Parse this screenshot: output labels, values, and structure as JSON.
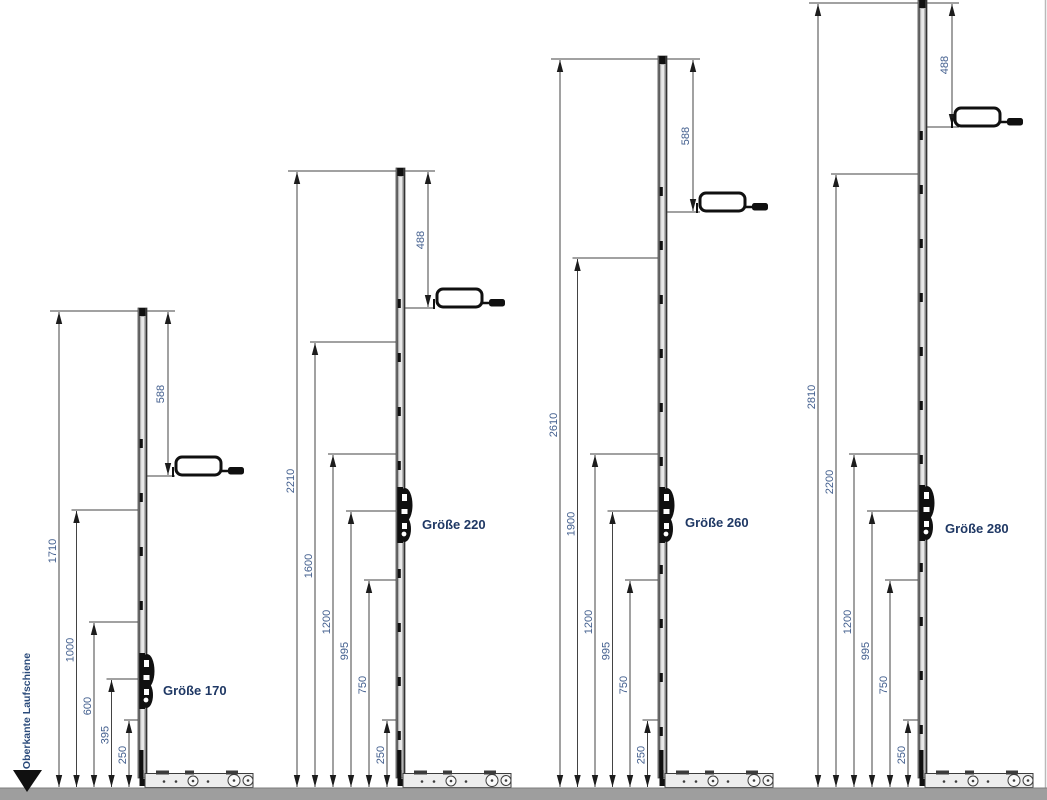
{
  "drawing": {
    "datum_label": "Oberkante Laufschiene",
    "units": [
      {
        "name": "Größe 170",
        "total_mm": 1710,
        "left_dims_mm": [
          1710,
          1000,
          600,
          395,
          250
        ],
        "handle_dim_mm": 588
      },
      {
        "name": "Größe 220",
        "total_mm": 2210,
        "left_dims_mm": [
          2210,
          1600,
          1200,
          995,
          750,
          250
        ],
        "handle_dim_mm": 488
      },
      {
        "name": "Größe 260",
        "total_mm": 2610,
        "left_dims_mm": [
          2610,
          1900,
          1200,
          995,
          750,
          250
        ],
        "handle_dim_mm": 588
      },
      {
        "name": "Größe 280",
        "total_mm": 2810,
        "left_dims_mm": [
          2810,
          2200,
          1200,
          995,
          750,
          250
        ],
        "handle_dim_mm": 488
      }
    ],
    "colors": {
      "dim_text": "#44608f",
      "label_text": "#1f3864",
      "datum_text": "#2a4a7a",
      "line": "#434343",
      "arrow": "#1c1c1c",
      "rail_fill": "#b5b5b5",
      "rail_light": "#e9e9e9",
      "hardware": "#101010",
      "baseline_bar": "#9e9e9e",
      "background": "#ffffff"
    },
    "scale_px_per_mm": 0.28
  }
}
